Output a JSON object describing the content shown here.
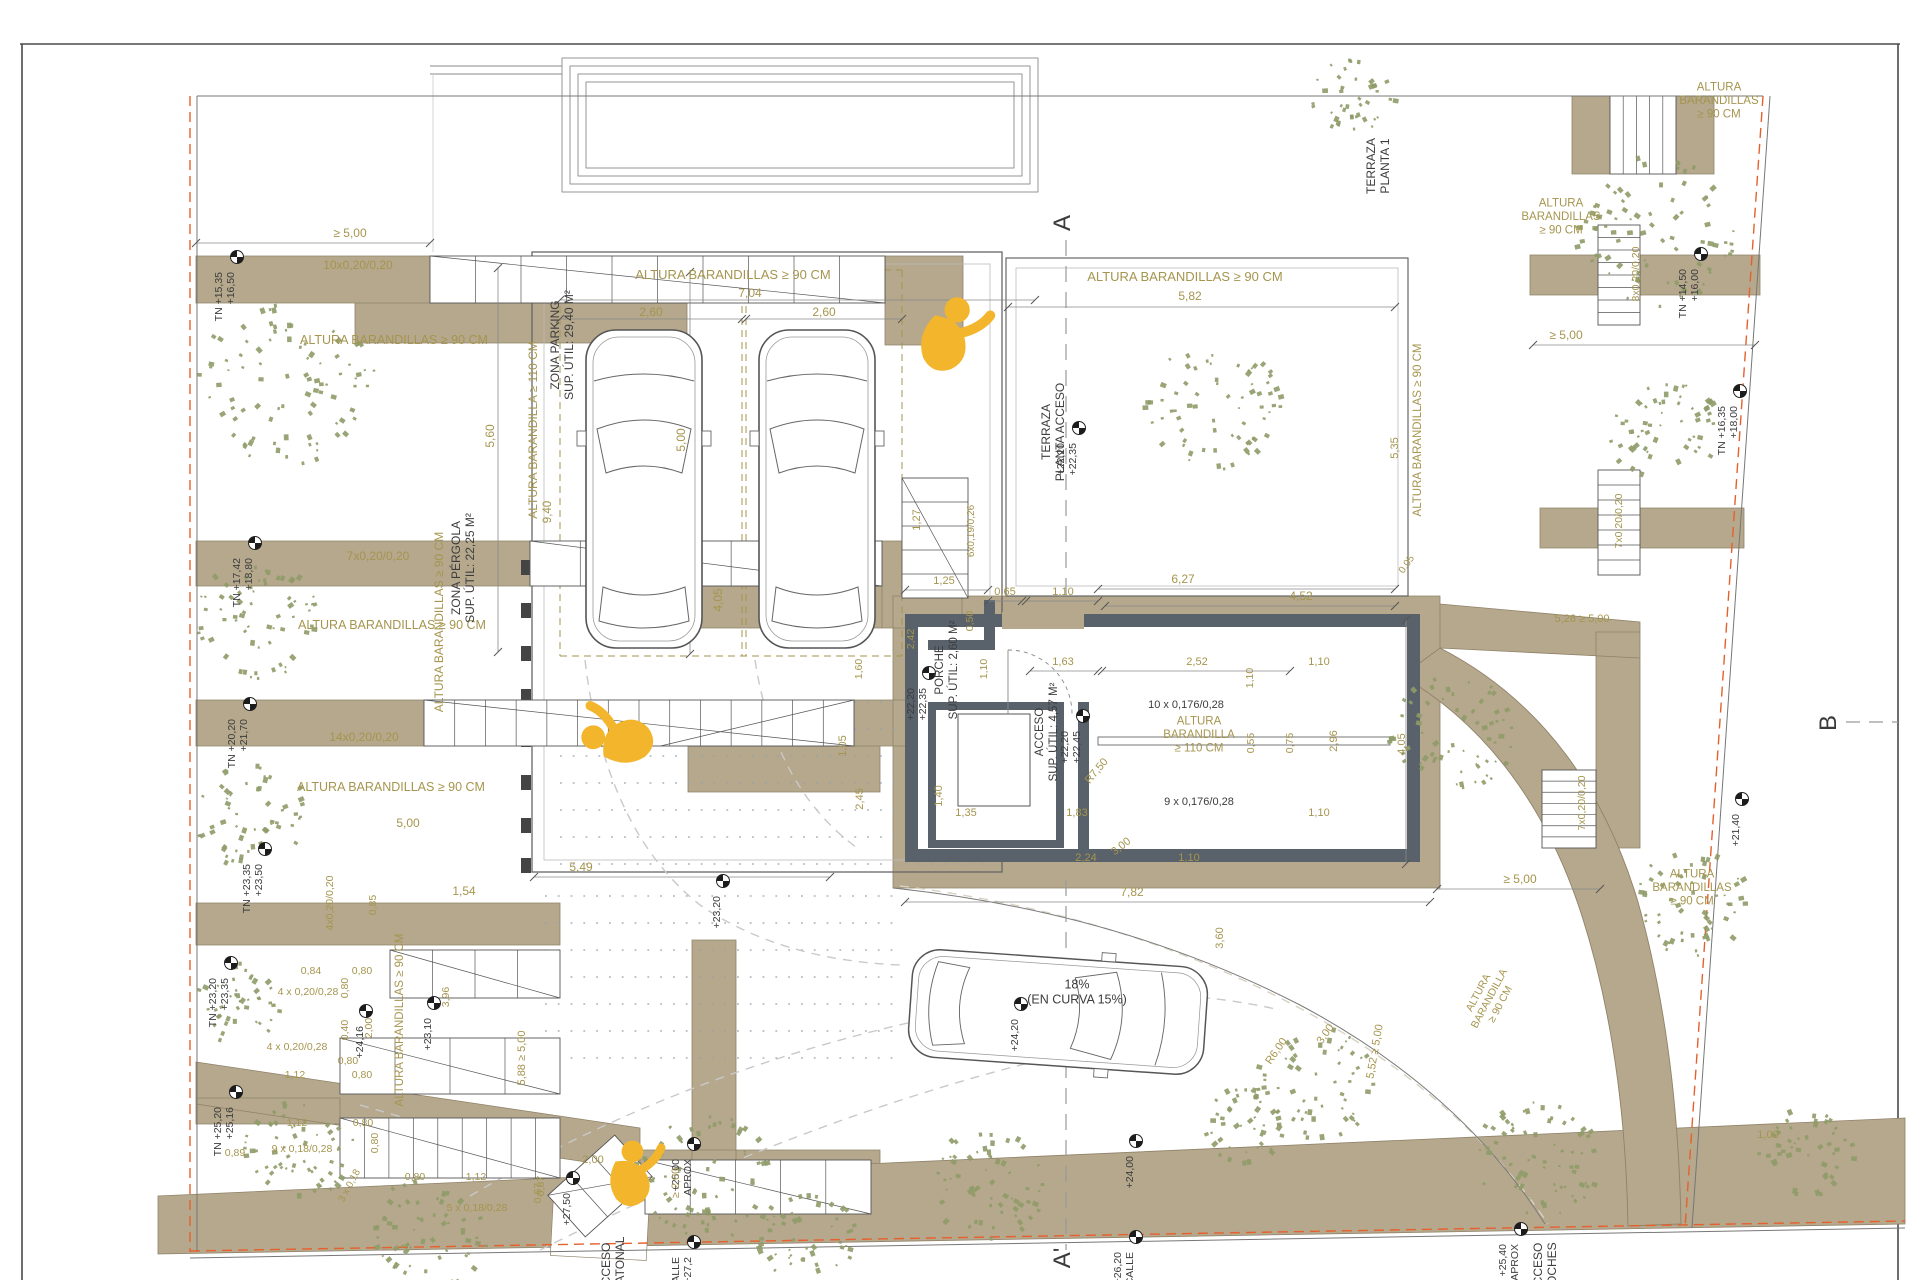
{
  "plan": {
    "colors": {
      "dim": "#a5954e",
      "ink": "#3c3c3c",
      "beige": "#b5a88c",
      "beige_edge": "#8f8269",
      "wall": "#59616a",
      "tree": "#8f9b68",
      "boundary": "#e6602e",
      "accent_yellow": "#f2b52b",
      "line": "#6a6a6a",
      "dash": "#c9c9c9"
    },
    "labels": [
      {
        "t": "ALTURA BARANDILLAS ≥ 90 CM",
        "x": 733,
        "y": 279,
        "s": 13,
        "n": "railing-note"
      },
      {
        "t": "7,04",
        "x": 750,
        "y": 297
      },
      {
        "t": "2,60",
        "x": 651,
        "y": 316
      },
      {
        "t": "2,60",
        "x": 824,
        "y": 316
      },
      {
        "t": "5,60",
        "x": 494,
        "y": 436,
        "r": -90
      },
      {
        "t": "ALTURA BARANDILLA ≥ 110 CM",
        "x": 537,
        "y": 430,
        "r": -90,
        "s": 12,
        "n": "railing-note"
      },
      {
        "t": "5,00",
        "x": 685,
        "y": 440,
        "r": -90
      },
      {
        "t": "9,40",
        "x": 551,
        "y": 512,
        "r": -90,
        "s": 11.5
      },
      {
        "t": "ALTURA BARANDILLAS ≥ 90 CM",
        "x": 1185,
        "y": 281,
        "s": 13,
        "n": "railing-note"
      },
      {
        "t": "5,82",
        "x": 1190,
        "y": 300
      },
      {
        "t": "ALTURA BARANDILLAS ≥ 90 CM",
        "x": 443,
        "y": 622,
        "r": -90,
        "s": 12,
        "n": "railing-note"
      },
      {
        "t": "4,05",
        "x": 722,
        "y": 600,
        "r": -90
      },
      {
        "t": "≥ 5,00",
        "x": 350,
        "y": 237
      },
      {
        "t": "10x0,20/0,20",
        "x": 358,
        "y": 269,
        "n": "stair-note"
      },
      {
        "t": "ALTURA BARANDILLAS ≥ 90 CM",
        "x": 394,
        "y": 344,
        "s": 12.5,
        "n": "railing-note"
      },
      {
        "t": "7x0,20/0,20",
        "x": 378,
        "y": 560,
        "n": "stair-note"
      },
      {
        "t": "ALTURA BARANDILLAS ≥ 90 CM",
        "x": 392,
        "y": 629,
        "s": 12.5,
        "n": "railing-note"
      },
      {
        "t": "14x0,20/0,20",
        "x": 364,
        "y": 741,
        "n": "stair-note"
      },
      {
        "t": "ALTURA BARANDILLAS ≥ 90 CM",
        "x": 391,
        "y": 791,
        "s": 12.5,
        "n": "railing-note"
      },
      {
        "t": "5,00",
        "x": 408,
        "y": 827
      },
      {
        "t": "4x0,20/0,20",
        "x": 333,
        "y": 903,
        "r": -90,
        "s": 10.5,
        "n": "stair-note"
      },
      {
        "t": "0,85",
        "x": 376,
        "y": 905,
        "r": -90,
        "s": 10.5
      },
      {
        "t": "1,54",
        "x": 464,
        "y": 895
      },
      {
        "t": "ALTURA BARANDILLAS ≥ 90 CM",
        "x": 403,
        "y": 1020,
        "r": -90,
        "s": 11.5,
        "n": "railing-note"
      },
      {
        "t": "0,84",
        "x": 311,
        "y": 974,
        "s": 10.5
      },
      {
        "t": "0,80",
        "x": 362,
        "y": 974,
        "s": 10.5
      },
      {
        "t": "4 x 0,20/0,28",
        "x": 308,
        "y": 995,
        "s": 10.5,
        "n": "stair-note"
      },
      {
        "t": "0,80",
        "x": 348,
        "y": 988,
        "r": -90,
        "s": 10.5
      },
      {
        "t": "0,40",
        "x": 348,
        "y": 1030,
        "r": -90,
        "s": 10.5
      },
      {
        "t": "2,00",
        "x": 372,
        "y": 1028,
        "r": -90,
        "s": 10.5
      },
      {
        "t": "4 x 0,20/0,28",
        "x": 297,
        "y": 1050,
        "s": 10.5,
        "n": "stair-note"
      },
      {
        "t": "0,80",
        "x": 348,
        "y": 1064,
        "s": 10.5
      },
      {
        "t": "1,12",
        "x": 295,
        "y": 1078,
        "s": 10.5
      },
      {
        "t": "0,80",
        "x": 362,
        "y": 1078,
        "s": 10.5
      },
      {
        "t": "0,89",
        "x": 235,
        "y": 1156,
        "s": 10.5
      },
      {
        "t": "1,12",
        "x": 297,
        "y": 1126,
        "s": 10.5
      },
      {
        "t": "0,80",
        "x": 363,
        "y": 1126,
        "s": 10.5
      },
      {
        "t": "9 x 0,18/0,28",
        "x": 302,
        "y": 1152,
        "s": 10.5,
        "n": "stair-note"
      },
      {
        "t": "0,80",
        "x": 378,
        "y": 1143,
        "r": -90,
        "s": 10.5
      },
      {
        "t": "3 x 0,18",
        "x": 352,
        "y": 1187,
        "r": -62,
        "s": 10,
        "n": "stair-note"
      },
      {
        "t": "0,80",
        "x": 415,
        "y": 1180,
        "s": 10.5
      },
      {
        "t": "1,12",
        "x": 476,
        "y": 1180,
        "s": 10.5
      },
      {
        "t": "5 x 0,18/0,28",
        "x": 477,
        "y": 1211,
        "s": 10.5,
        "n": "stair-note"
      },
      {
        "t": "0,67",
        "x": 541,
        "y": 1193,
        "r": -90,
        "s": 10.5
      },
      {
        "t": "3,96",
        "x": 449,
        "y": 997,
        "r": -90,
        "s": 10.5
      },
      {
        "t": "5,88 ≥ 5,00",
        "x": 525,
        "y": 1058,
        "r": -90,
        "s": 11
      },
      {
        "t": "5,49",
        "x": 581,
        "y": 871
      },
      {
        "t": "2,00",
        "x": 593,
        "y": 1163,
        "s": 11
      },
      {
        "t": "0,87",
        "x": 544,
        "y": 1186,
        "r": -90,
        "s": 10.5
      },
      {
        "t": "≥ 2,00",
        "x": 679,
        "y": 1183,
        "r": -90,
        "s": 11
      },
      {
        "t": "7,82",
        "x": 1132,
        "y": 896
      },
      {
        "t": "2,45",
        "x": 863,
        "y": 799,
        "r": -90,
        "s": 11
      },
      {
        "t": "1,05",
        "x": 846,
        "y": 746,
        "r": -90,
        "s": 11
      },
      {
        "t": "1,40",
        "x": 942,
        "y": 796,
        "r": -90,
        "s": 11
      },
      {
        "t": "1,35",
        "x": 966,
        "y": 816,
        "s": 11
      },
      {
        "t": "1,83",
        "x": 1077,
        "y": 816,
        "s": 11
      },
      {
        "t": "2,24",
        "x": 1086,
        "y": 861,
        "s": 11
      },
      {
        "t": "1,10",
        "x": 1189,
        "y": 861,
        "s": 11
      },
      {
        "t": "1,25",
        "x": 944,
        "y": 584,
        "s": 11
      },
      {
        "t": "1,27",
        "x": 920,
        "y": 520,
        "r": -90,
        "s": 11
      },
      {
        "t": "6x0,19/0,26",
        "x": 974,
        "y": 531,
        "r": -90,
        "s": 10,
        "n": "stair-note"
      },
      {
        "t": "0,50",
        "x": 973,
        "y": 621,
        "r": -90,
        "s": 10.5
      },
      {
        "t": "1,10",
        "x": 987,
        "y": 669,
        "r": -90,
        "s": 10.5
      },
      {
        "t": "2,42",
        "x": 914,
        "y": 639,
        "r": -90,
        "s": 10.5
      },
      {
        "t": "1,60",
        "x": 862,
        "y": 669,
        "r": -90,
        "s": 10.5
      },
      {
        "t": "0,65",
        "x": 1005,
        "y": 595,
        "s": 11
      },
      {
        "t": "1,10",
        "x": 1063,
        "y": 595,
        "s": 11
      },
      {
        "t": "1,63",
        "x": 1063,
        "y": 665,
        "s": 11
      },
      {
        "t": "2,52",
        "x": 1197,
        "y": 665,
        "s": 11
      },
      {
        "t": "6,27",
        "x": 1183,
        "y": 583
      },
      {
        "t": "4,52",
        "x": 1301,
        "y": 600
      },
      {
        "t": "0,05",
        "x": 1409,
        "y": 566,
        "r": -55,
        "s": 10
      },
      {
        "t": "10 x 0,176/0,28",
        "x": 1186,
        "y": 708,
        "s": 11,
        "c": "ink",
        "n": "stair-note"
      },
      {
        "L": [
          "ALTURA",
          "BARANDILLA",
          "≥ 110 CM"
        ],
        "x": 1199,
        "y": 738,
        "s": 11.5,
        "n": "railing-note"
      },
      {
        "t": "9 x 0,176/0,28",
        "x": 1199,
        "y": 805,
        "s": 11,
        "c": "ink",
        "n": "stair-note"
      },
      {
        "t": "0,55",
        "x": 1254,
        "y": 743,
        "r": -90,
        "s": 10.5
      },
      {
        "t": "0,75",
        "x": 1293,
        "y": 743,
        "r": -90,
        "s": 10.5
      },
      {
        "t": "1,10",
        "x": 1319,
        "y": 665,
        "s": 11
      },
      {
        "t": "1,10",
        "x": 1319,
        "y": 816,
        "s": 11
      },
      {
        "t": "1,10",
        "x": 1253,
        "y": 678,
        "r": -90,
        "s": 10.5
      },
      {
        "t": "2,96",
        "x": 1337,
        "y": 741,
        "r": -90,
        "s": 11
      },
      {
        "t": "4,05",
        "x": 1405,
        "y": 744,
        "r": -90,
        "s": 11
      },
      {
        "t": "5,26 ≥ 5,00",
        "x": 1582,
        "y": 622,
        "s": 11
      },
      {
        "t": "ALTURA BARANDILLAS ≥ 90 CM",
        "x": 1421,
        "y": 430,
        "r": -90,
        "s": 11.5,
        "n": "railing-note"
      },
      {
        "t": "5,35",
        "x": 1398,
        "y": 448,
        "r": -90,
        "s": 11
      },
      {
        "L": [
          "ALTURA",
          "BARANDILLAS",
          "≥ 90 CM"
        ],
        "x": 1719,
        "y": 104,
        "s": 11.5,
        "n": "railing-note"
      },
      {
        "L": [
          "ALTURA",
          "BARANDILLAS",
          "≥ 90 CM"
        ],
        "x": 1561,
        "y": 220,
        "s": 11.5,
        "n": "railing-note"
      },
      {
        "t": "8x0,20/0,20",
        "x": 1639,
        "y": 274,
        "r": -90,
        "s": 10.5,
        "n": "stair-note"
      },
      {
        "t": "≥ 5,00",
        "x": 1566,
        "y": 339
      },
      {
        "t": "7x0,20/0,20",
        "x": 1622,
        "y": 521,
        "r": -90,
        "s": 10.5,
        "n": "stair-note"
      },
      {
        "t": "7x0,20/0,20",
        "x": 1585,
        "y": 803,
        "r": -90,
        "s": 10.5,
        "n": "stair-note"
      },
      {
        "t": "≥ 5,00",
        "x": 1520,
        "y": 883
      },
      {
        "L": [
          "ALTURA",
          "BARANDILLAS",
          "≥ 90 CM"
        ],
        "x": 1692,
        "y": 891,
        "s": 11.5,
        "n": "railing-note"
      },
      {
        "L": [
          "ALTURA",
          "BARANDILLA",
          "≥ 90 CM"
        ],
        "x": 1492,
        "y": 1000,
        "r": -62,
        "s": 10.5,
        "n": "railing-note"
      },
      {
        "t": "R6,00",
        "x": 1279,
        "y": 1053,
        "r": -55,
        "s": 11
      },
      {
        "t": "3,00",
        "x": 1328,
        "y": 1036,
        "r": -55,
        "s": 11
      },
      {
        "t": "5,52 ≥ 5,00",
        "x": 1378,
        "y": 1052,
        "r": -80,
        "s": 11
      },
      {
        "t": "R7,50",
        "x": 1099,
        "y": 773,
        "r": -50,
        "s": 11
      },
      {
        "t": "3,00",
        "x": 1123,
        "y": 849,
        "r": -38,
        "s": 11
      },
      {
        "t": "3,60",
        "x": 1223,
        "y": 938,
        "r": -90,
        "s": 11
      },
      {
        "t": "1,00",
        "x": 1768,
        "y": 1138,
        "s": 11
      },
      {
        "L": [
          "ZONA PARKING",
          "SUP. ÚTIL: 29,40 M²"
        ],
        "x": 566,
        "y": 345,
        "r": -90,
        "s": 12,
        "c": "ink",
        "n": "room-label-zona-parking"
      },
      {
        "L": [
          "ZONA PÉRGOLA",
          "SUP. ÚTIL: 22,25 M²"
        ],
        "x": 467,
        "y": 568,
        "r": -90,
        "s": 12,
        "c": "ink",
        "n": "room-label-zona-pergola"
      },
      {
        "L": [
          "PORCHE",
          "SUP. ÚTIL: 2,60 M²"
        ],
        "x": 950,
        "y": 670,
        "r": -90,
        "s": 11.5,
        "c": "ink",
        "n": "room-label-porche"
      },
      {
        "L": [
          "ACCESO",
          "SUP. ÚTIL: 4,57 M²"
        ],
        "x": 1050,
        "y": 732,
        "r": -90,
        "s": 11.5,
        "c": "ink",
        "n": "room-label-acceso"
      },
      {
        "L": [
          "TERRAZA",
          "PLANTA 1"
        ],
        "x": 1382,
        "y": 166,
        "r": -90,
        "s": 12,
        "c": "ink",
        "n": "room-label-terraza-planta-1"
      },
      {
        "L": [
          "TERRAZA",
          "PLANTA ACCESO"
        ],
        "x": 1057,
        "y": 432,
        "r": -90,
        "s": 12,
        "c": "ink",
        "n": "room-label-terraza-planta-acceso"
      },
      {
        "L": [
          "18%",
          "(EN CURVA 15%)"
        ],
        "x": 1077,
        "y": 996,
        "s": 12.5,
        "c": "ink",
        "n": "ramp-slope-note"
      },
      {
        "t": "A",
        "x": 1070,
        "y": 223,
        "r": -90,
        "s": 24,
        "c": "ink",
        "n": "section-marker-a"
      },
      {
        "t": "A'",
        "x": 1070,
        "y": 1258,
        "r": -90,
        "s": 24,
        "c": "ink",
        "n": "section-marker-a-prime"
      },
      {
        "t": "B",
        "x": 1836,
        "y": 723,
        "r": -90,
        "s": 24,
        "c": "ink",
        "n": "section-marker-b"
      },
      {
        "L": [
          "ACCESO",
          "PEATONAL"
        ],
        "x": 617,
        "y": 1268,
        "r": -90,
        "s": 12,
        "c": "ink",
        "n": "street-label-acceso-peatonal"
      },
      {
        "L": [
          "ACCESO",
          "COCHES"
        ],
        "x": 1549,
        "y": 1268,
        "r": -90,
        "s": 12,
        "c": "ink",
        "n": "street-label-acceso-coches"
      }
    ],
    "level_markers": [
      {
        "x": 237,
        "y": 257,
        "L": [
          "+16,50",
          "TN +15,35"
        ]
      },
      {
        "x": 255,
        "y": 543,
        "L": [
          "+18,80",
          "TN +17,42"
        ]
      },
      {
        "x": 250,
        "y": 704,
        "L": [
          "+21,70",
          "TN +20,20"
        ]
      },
      {
        "x": 265,
        "y": 849,
        "L": [
          "+23,50",
          "TN +23,35"
        ]
      },
      {
        "x": 231,
        "y": 963,
        "L": [
          "+23,35",
          "TN +23,20"
        ]
      },
      {
        "x": 236,
        "y": 1092,
        "L": [
          "+25,16",
          "TN +25,20"
        ]
      },
      {
        "x": 366,
        "y": 1011,
        "L": [
          "+24,16"
        ]
      },
      {
        "x": 434,
        "y": 1003,
        "L": [
          "+23,10"
        ]
      },
      {
        "x": 573,
        "y": 1178,
        "L": [
          "+27,50"
        ]
      },
      {
        "x": 694,
        "y": 1144,
        "L": [
          "APROX",
          "+25,00"
        ]
      },
      {
        "x": 694,
        "y": 1242,
        "L": [
          "APROX +27,2",
          "CALLE"
        ]
      },
      {
        "x": 1136,
        "y": 1237,
        "L": [
          "CALLE",
          "+26,20"
        ]
      },
      {
        "x": 1136,
        "y": 1141,
        "L": [
          "+24,00"
        ]
      },
      {
        "x": 1021,
        "y": 1004,
        "L": [
          "+24,20"
        ]
      },
      {
        "x": 1079,
        "y": 428,
        "L": [
          "+22,35",
          "+22,20"
        ]
      },
      {
        "x": 929,
        "y": 673,
        "L": [
          "+22,35",
          "+22,20"
        ]
      },
      {
        "x": 1083,
        "y": 716,
        "L": [
          "+22,45",
          "+22,20"
        ]
      },
      {
        "x": 723,
        "y": 881,
        "L": [
          "+23,20"
        ]
      },
      {
        "x": 1701,
        "y": 254,
        "L": [
          "+16,00",
          "TN +14,50"
        ]
      },
      {
        "x": 1740,
        "y": 391,
        "L": [
          "+18,00",
          "TN +16,35"
        ]
      },
      {
        "x": 1742,
        "y": 799,
        "L": [
          "+21,40"
        ]
      },
      {
        "x": 1521,
        "y": 1229,
        "L": [
          "APROX",
          "+25,40"
        ]
      }
    ],
    "vegetation": [
      [
        287,
        383,
        88
      ],
      [
        258,
        622,
        62
      ],
      [
        252,
        816,
        56
      ],
      [
        237,
        1004,
        42
      ],
      [
        300,
        1152,
        55
      ],
      [
        428,
        1232,
        60
      ],
      [
        706,
        1176,
        68
      ],
      [
        808,
        1237,
        48
      ],
      [
        988,
        1184,
        58
      ],
      [
        1213,
        407,
        68
      ],
      [
        1317,
        1085,
        60
      ],
      [
        1243,
        1124,
        40
      ],
      [
        1452,
        733,
        62
      ],
      [
        1657,
        232,
        80
      ],
      [
        1663,
        428,
        56
      ],
      [
        1692,
        903,
        56
      ],
      [
        1537,
        1160,
        62
      ],
      [
        1806,
        1153,
        46
      ],
      [
        1352,
        92,
        42
      ]
    ],
    "figures": [
      {
        "x": 945,
        "y": 336,
        "s": 1.8,
        "r": 25
      },
      {
        "x": 620,
        "y": 742,
        "s": 1.7,
        "r": -80
      },
      {
        "x": 629,
        "y": 1176,
        "s": 1.55,
        "r": 8
      }
    ]
  }
}
